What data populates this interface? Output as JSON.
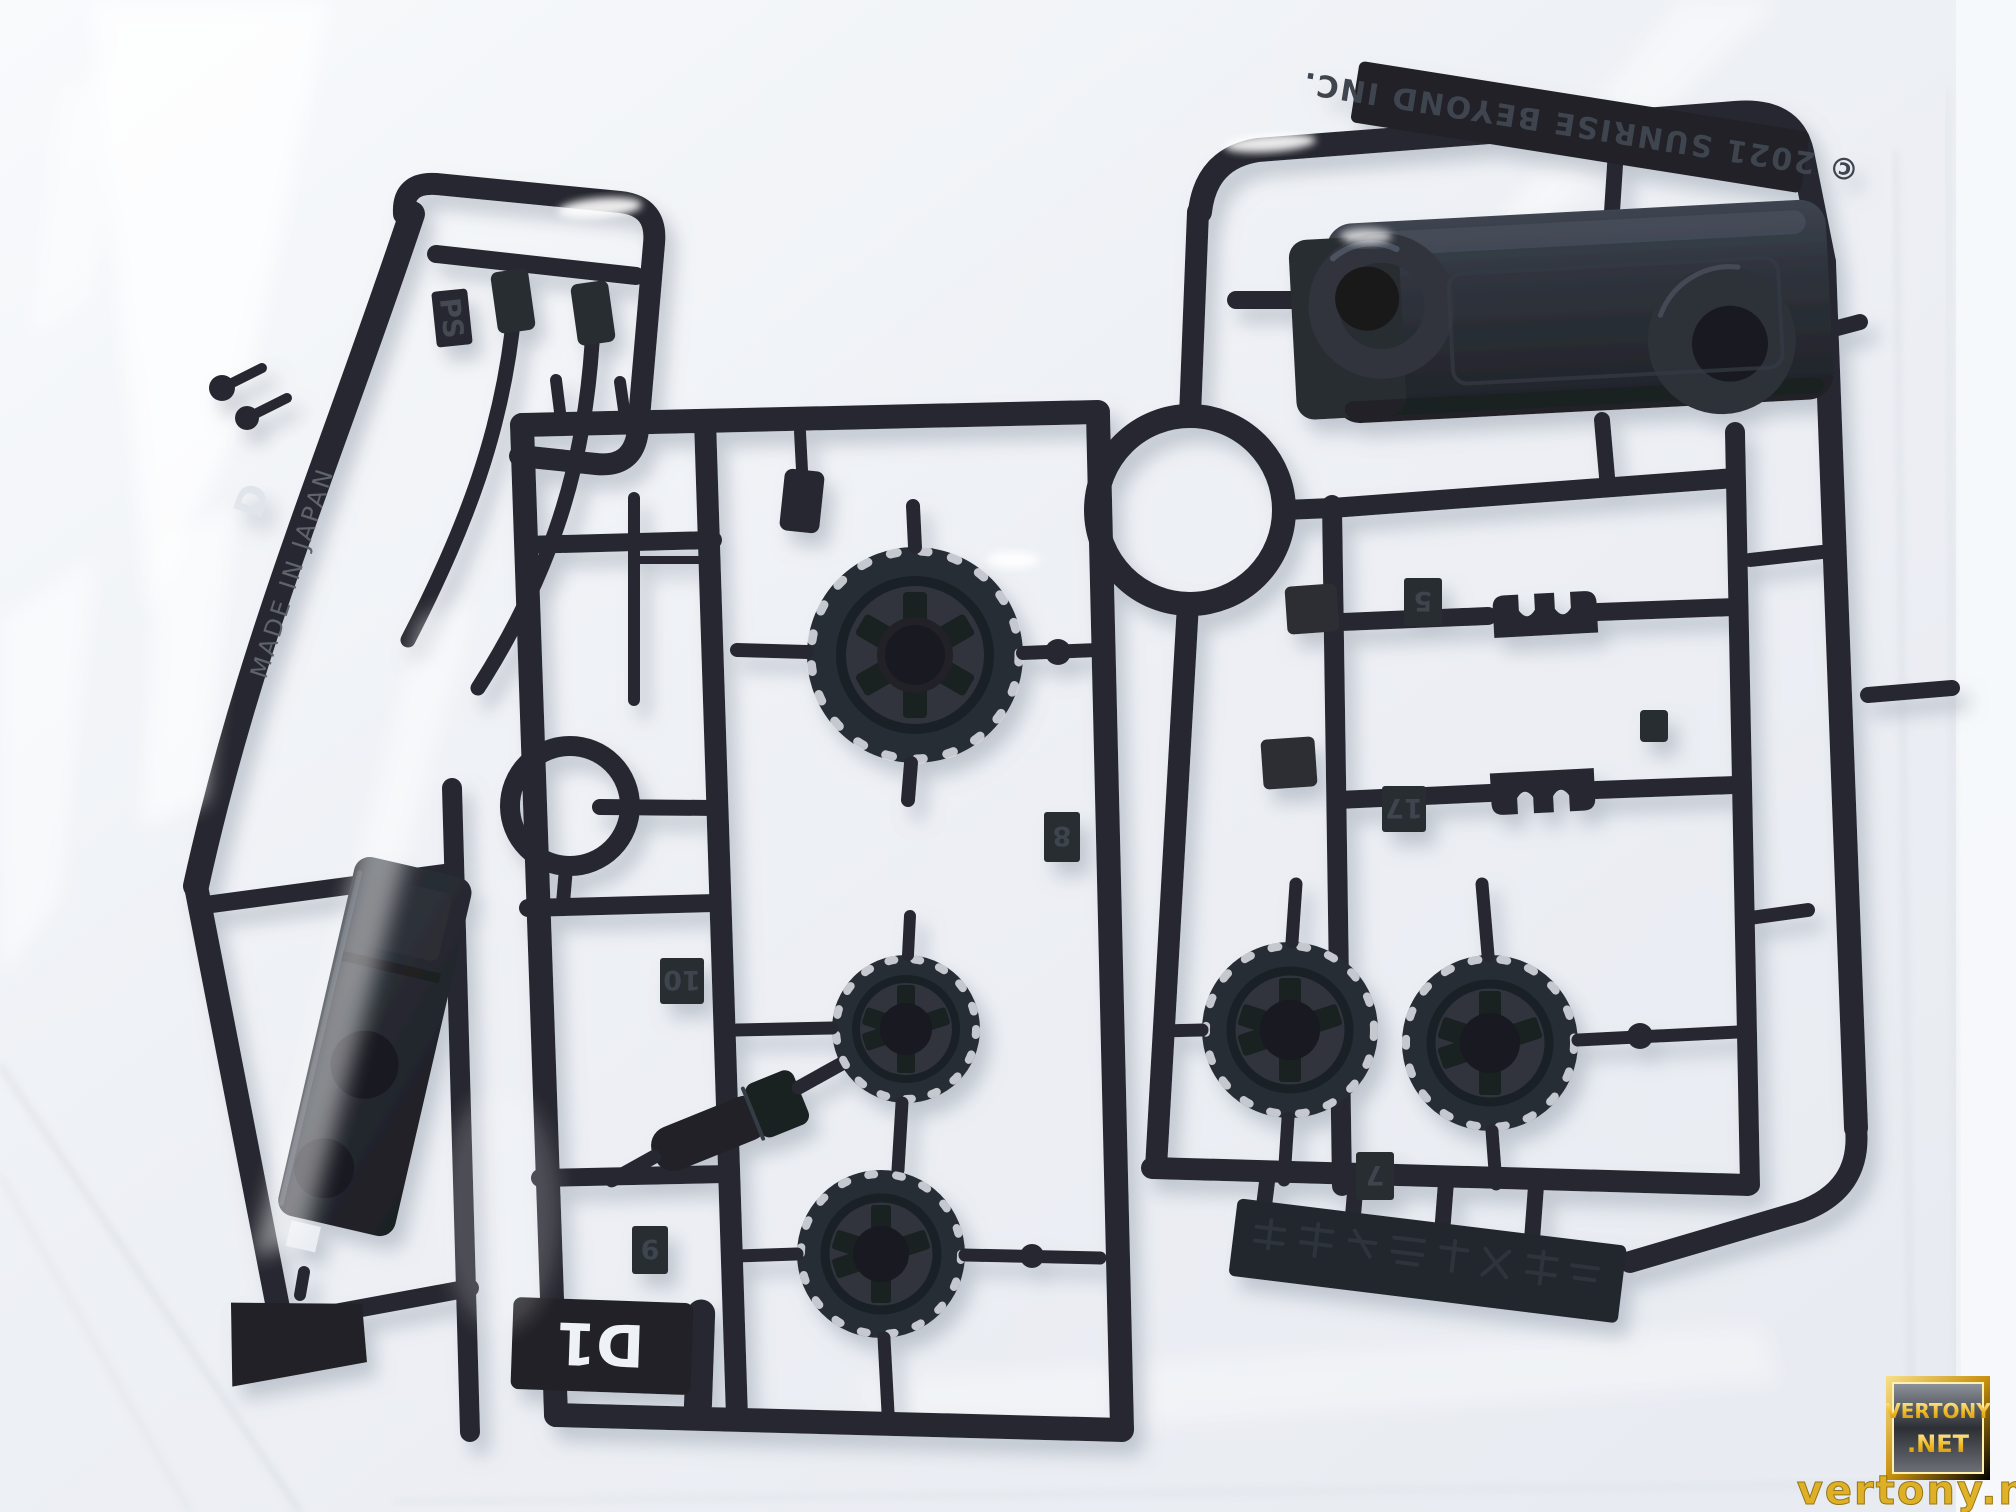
{
  "molding": {
    "copyright_text": "© 2021 SUNRISE BEYOND INC.",
    "material_code": "PS",
    "origin_text": "MADE IN JAPAN",
    "runner_letter": "D",
    "runner_tag": "D1",
    "part_numbers": {
      "n5": "5",
      "n7": "7",
      "n8": "8",
      "n9": "9",
      "n10": "10",
      "n17": "17"
    }
  },
  "watermark": {
    "line1": "VERTONY",
    "line2": ".NET",
    "url": "vertony.net"
  },
  "colors": {
    "plastic": "#1b1e25",
    "plastic_light": "#2a2f39",
    "bag": "#edf0f5",
    "gold": "#e8b425",
    "shadow": "#9aa3af"
  }
}
